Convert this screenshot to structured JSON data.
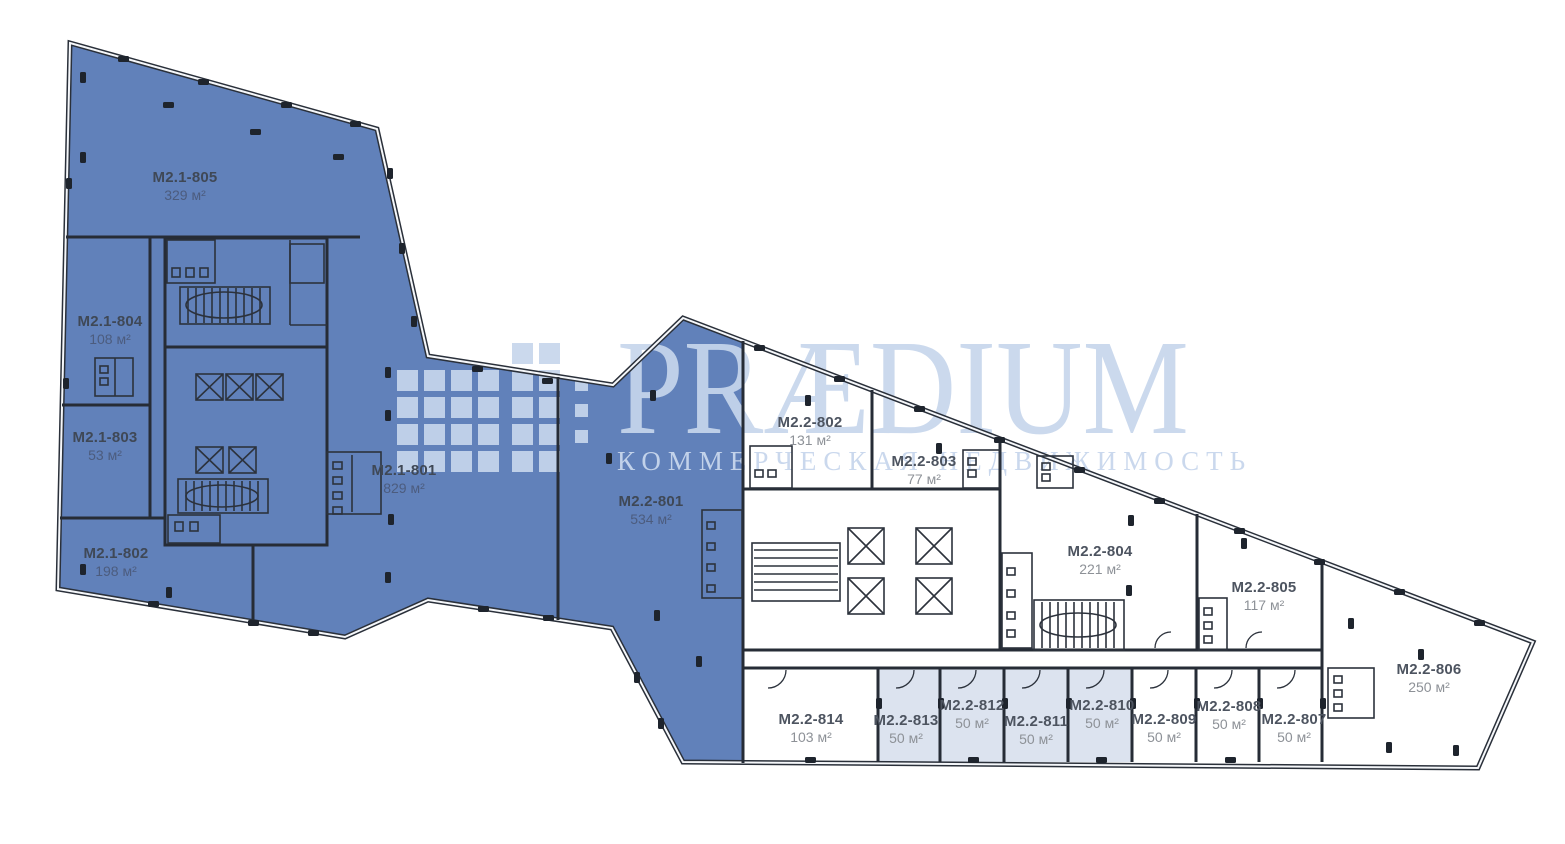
{
  "watermark": {
    "brand": "PRÆDIUM",
    "tagline": "КОММЕРЧЕСКАЯ НЕДВИЖИМОСТЬ"
  },
  "colors": {
    "available_blue": "#6181ba",
    "highlight_light": "#dce3ef",
    "wall_dark": "#262c36",
    "watermark_blue": "#c7d6eb"
  },
  "units": [
    {
      "id": "M2.1-805",
      "area": "329 м²",
      "status": "blue"
    },
    {
      "id": "M2.1-804",
      "area": "108 м²",
      "status": "blue"
    },
    {
      "id": "M2.1-803",
      "area": "53 м²",
      "status": "blue"
    },
    {
      "id": "M2.1-802",
      "area": "198 м²",
      "status": "blue"
    },
    {
      "id": "M2.1-801",
      "area": "829 м²",
      "status": "blue"
    },
    {
      "id": "M2.2-801",
      "area": "534 м²",
      "status": "blue"
    },
    {
      "id": "M2.2-802",
      "area": "131 м²",
      "status": "white"
    },
    {
      "id": "M2.2-803",
      "area": "77 м²",
      "status": "white"
    },
    {
      "id": "M2.2-804",
      "area": "221 м²",
      "status": "white"
    },
    {
      "id": "M2.2-805",
      "area": "117 м²",
      "status": "white"
    },
    {
      "id": "M2.2-806",
      "area": "250 м²",
      "status": "white"
    },
    {
      "id": "M2.2-807",
      "area": "50 м²",
      "status": "white"
    },
    {
      "id": "M2.2-808",
      "area": "50 м²",
      "status": "white"
    },
    {
      "id": "M2.2-809",
      "area": "50 м²",
      "status": "white"
    },
    {
      "id": "M2.2-810",
      "area": "50 м²",
      "status": "light"
    },
    {
      "id": "M2.2-811",
      "area": "50 м²",
      "status": "light"
    },
    {
      "id": "M2.2-812",
      "area": "50 м²",
      "status": "light"
    },
    {
      "id": "M2.2-813",
      "area": "50 м²",
      "status": "light"
    },
    {
      "id": "M2.2-814",
      "area": "103 м²",
      "status": "white"
    }
  ]
}
